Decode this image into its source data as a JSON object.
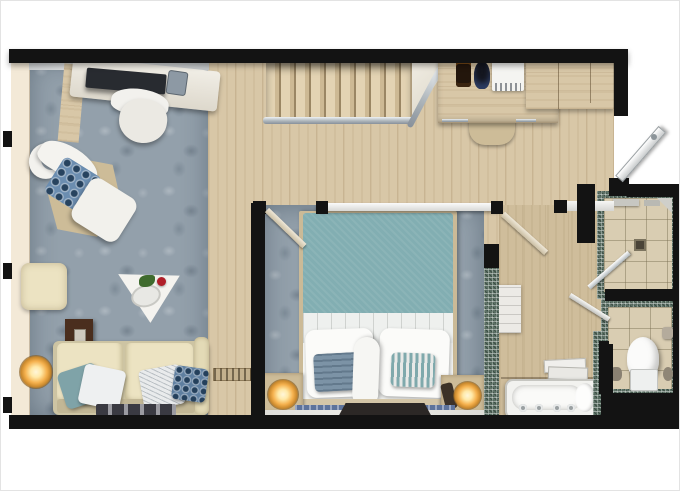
{
  "document": {
    "type": "floor-plan",
    "title": "Hotel suite floor plan (top-down 3D render)",
    "visible_text": []
  },
  "palette": {
    "wall": "#131313",
    "wood": "#d8c7a7",
    "tan_floor": "#cfbd9b",
    "furniture_tan": "#cdbc98",
    "carpet": "#93a0ab",
    "tile": "#d9cdb2",
    "mosaic": "#5c7065",
    "duvet_teal": "#82aeb2",
    "sofa_beige": "#ece3c2",
    "window_cream": "#f3e9d7",
    "table_brown": "#4a2e1e",
    "lamp_glow": "#f5b14e",
    "fixture_white": "#f4f4f1",
    "marble": "#e6e4df",
    "pillow_blue": "#6b8db0",
    "runner_blue": "#5d739b",
    "metal": "#b9c0c4",
    "tv_gray": "#babdc1"
  },
  "rooms": {
    "living_room": {
      "floor": "carpet",
      "items": [
        "desk",
        "laptop",
        "telephone",
        "desk-chair",
        "wood-side-panel",
        "crescent-side-table",
        "armchair",
        "blue-seat-cushion",
        "hexagon-rug",
        "ottoman",
        "pouf",
        "triangle-coffee-table",
        "rose-decor",
        "dark-side-table",
        "remote-control",
        "floor-lamp",
        "sofa",
        "teal-throw-pillow",
        "white-throw-pillow",
        "patterned-throw-pillow",
        "blue-throw-pillow",
        "runner-rug",
        "window-ledge",
        "marble-sill"
      ]
    },
    "hall": {
      "floor": "wood",
      "items": [
        "staircase",
        "stair-railing",
        "stair-railing-diagonal",
        "doormat"
      ]
    },
    "kitchenette": {
      "items": [
        "counter",
        "coffee-machine",
        "kettle",
        "minibar",
        "cabinets",
        "stool",
        "drawer-handle"
      ]
    },
    "entry": {
      "items": [
        "entry-door"
      ]
    },
    "bedroom": {
      "floor": "carpet",
      "items": [
        "partition-wall",
        "wall-tv",
        "door",
        "bed",
        "duvet",
        "sheet-fold",
        "pillow-left",
        "pillow-right",
        "accent-cushion-left",
        "accent-cushion-right",
        "throw-roll",
        "headboard",
        "nightstand-left",
        "table-lamp-left",
        "nightstand-right",
        "table-lamp-right",
        "bedside-phone",
        "foot-bench",
        "runner-rug",
        "marble-ledge"
      ]
    },
    "bathroom": {
      "floor": "tan-wood",
      "items": [
        "door",
        "mosaic-partition",
        "linen-shelf",
        "towel-stack",
        "bathtub",
        "bath-pillow",
        "faucet-fixtures",
        "bath-mat"
      ]
    },
    "shower_room": {
      "floor": "tile",
      "items": [
        "glass-door",
        "floor-drain",
        "shelf",
        "corner-shelf"
      ]
    },
    "wc": {
      "floor": "tile",
      "items": [
        "door",
        "toilet",
        "cistern",
        "toilet-paper-holder",
        "toilet-brush",
        "accessories"
      ]
    }
  }
}
